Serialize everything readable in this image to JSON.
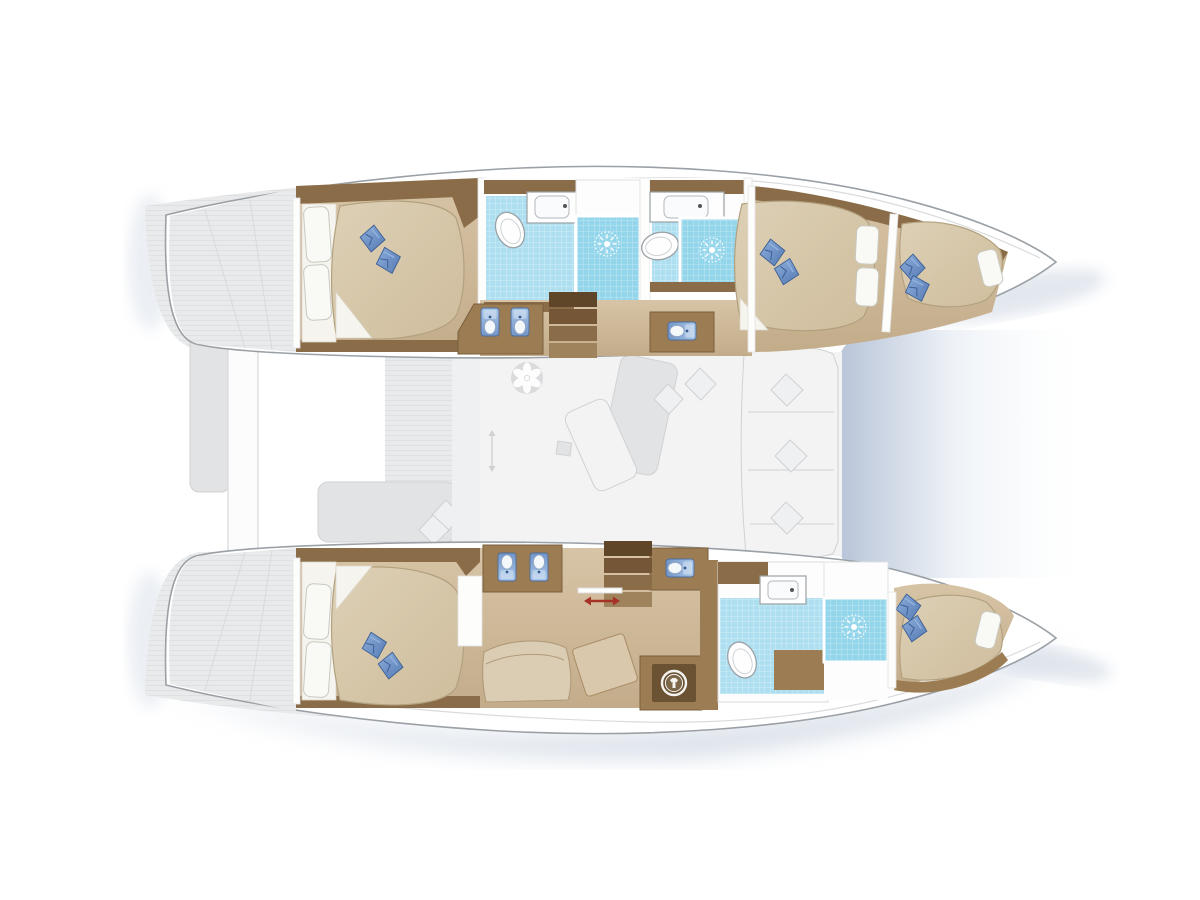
{
  "legend": {
    "vessel_type": "catamaran",
    "view": "overhead interior layout plan",
    "hulls": 2,
    "double_beds": 3,
    "forepeak_berths": 2,
    "bathrooms": 3,
    "shower_stalls": 3,
    "toilets": 3,
    "blue_washbasins": 6,
    "counter_sinks": 3,
    "companionway_stairs": 2,
    "sliding_door_markers": 1,
    "ceiling_fans": 1,
    "washing_machines": 1,
    "blue_cushion_pairs": 5
  },
  "icons": {
    "shower-rose-icon": "white sunburst on blue tile",
    "toilet-icon": "white oval bowl",
    "washbasin-icon": "blue basin with tap",
    "counter-sink-icon": "rounded square sink with tap dot",
    "ceiling-fan-icon": "six petal fan",
    "washing-machine-icon": "drum ring with shirt",
    "companionway-steps-icon": "stack of wooden steps",
    "sliding-door-arrow-icon": "red double-headed arrow",
    "beam-fitting-icon": "round deck fitting"
  },
  "palette": {
    "hull": "#ffffff",
    "hullStroke": "#9aa0a5",
    "hullInner": "#d9dbdd",
    "deck": "#e9eaeb",
    "deckEdge": "#d8d9db",
    "furn": "#e2e3e5",
    "furnEdge": "#d0d1d3",
    "saloon": "#f3f3f4",
    "shadow": "#b7c4d6",
    "wood": "#8a6c49",
    "woodMid": "#9c7c52",
    "woodDark": "#6b5233",
    "floorA": "#d7c4a6",
    "floorB": "#c3ac8a",
    "mattA": "#ddd0b5",
    "mattB": "#cfbd9d",
    "mattEdge": "#b2a17f",
    "sheet": "#f6f4ee",
    "sheetEdge": "#ddd6c8",
    "pillow": "#f9f9f6",
    "pillowEdge": "#c9c9c0",
    "cushA": "#8fb0dd",
    "cushB": "#5379b1",
    "cushEdge": "#3d5f95",
    "tile": "#aedff0",
    "tileDeep": "#93d5ea",
    "fixture": "#fefefe",
    "fixtureEdge": "#9aa1a6",
    "fixtureInner": "#cdd2d5",
    "basinA": "#a9c7e9",
    "basinB": "#7396c8",
    "basinEdge": "#4d6d9c",
    "arrow": "#a63225",
    "step1": "#5f4628",
    "step2": "#755738",
    "step3": "#8a6c49",
    "step4": "#9f835c",
    "trampA": "#b6c3d7",
    "trampB": "#eef2f7"
  }
}
